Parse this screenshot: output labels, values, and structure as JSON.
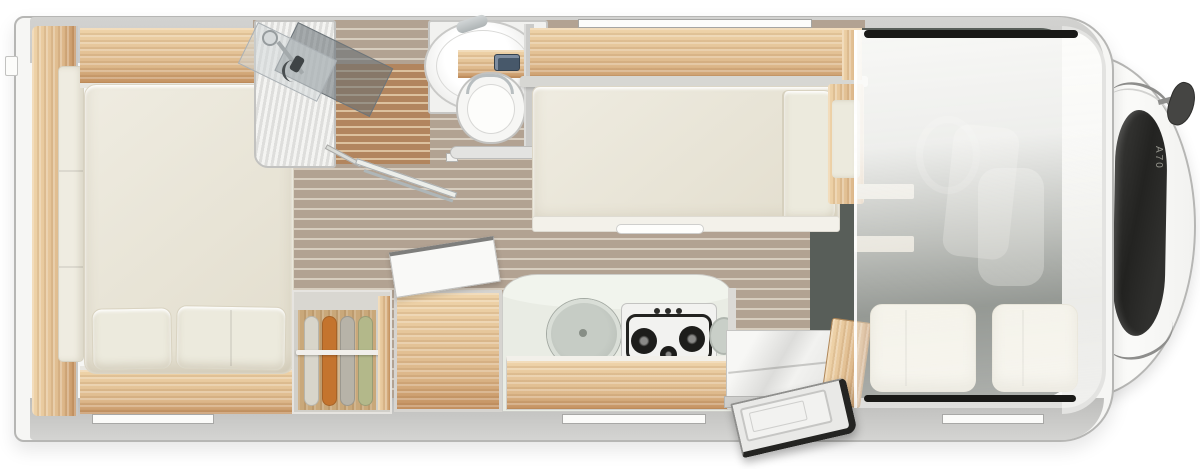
{
  "vehicle": {
    "model_label": "A70"
  },
  "palette": {
    "body": "#f6f6f4",
    "outline": "#b6b6b4",
    "wall": "#cbcbc9",
    "wall_dark": "#bdbdbb",
    "front_wall": "#e3e3e1",
    "wood": "#ddb88b",
    "wood_light": "#efd4aa",
    "wood_deep": "#c3905f",
    "floor": "#b2a292",
    "floor_stripe": "#d7cdbf",
    "teak": "#b2855e",
    "teak_stripe": "#dcc19e",
    "carpet": "#585e59",
    "mattress": "#efece1",
    "mattress_deep": "#e2ddcd",
    "pillow": "#eceadd",
    "counter": "#e9ece4",
    "sink": "#bcc2bb",
    "hob": "#f2f2f0",
    "burner": "#1d1d1b",
    "chrome": "#aeb6b8",
    "windshield": "#2b2b29",
    "cab_window": "#191917",
    "flush": "#47586a",
    "door_seal": "#242422",
    "red": "#c0392b",
    "clothes_1": "#d8d5ca",
    "clothes_2": "#c4742e",
    "clothes_3": "#b7b3a8",
    "clothes_4": "#b3b88a"
  },
  "fixtures": {
    "labels": [
      "rear-bed",
      "wardrobe-wall",
      "clothes-closet",
      "shower",
      "washbasin",
      "toilet",
      "sofa-bed",
      "kitchen-block",
      "covered-sink",
      "gas-hob",
      "entry-door",
      "dinette-seat",
      "cab-seats",
      "alcove-bed-overlay",
      "windshield",
      "side-mirror"
    ]
  }
}
